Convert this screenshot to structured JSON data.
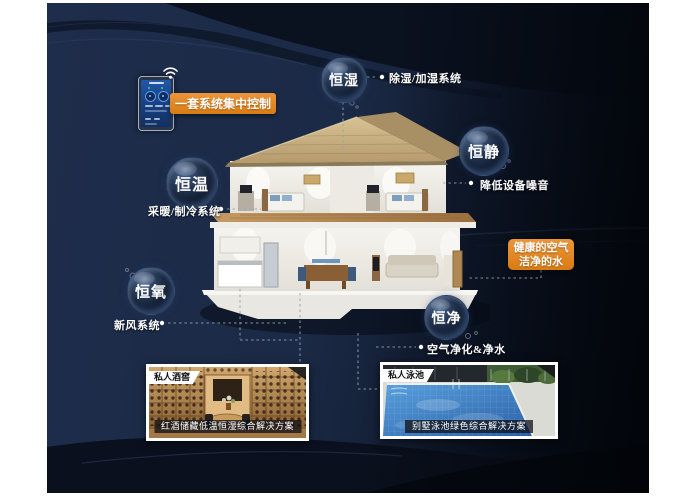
{
  "poster": {
    "control_callout": {
      "label": "一套系统集中控制"
    },
    "health_callout": {
      "line1": "健康的空气",
      "line2": "洁净的水"
    },
    "bubbles": [
      {
        "label": "恒湿",
        "note": "除湿/加湿系统"
      },
      {
        "label": "恒静",
        "note": "降低设备噪音"
      },
      {
        "label": "恒温",
        "note": "采暖/制冷系统"
      },
      {
        "label": "恒氧",
        "note": "新风系统"
      },
      {
        "label": "恒净",
        "note": "空气净化&净水"
      }
    ],
    "photos": [
      {
        "tag": "私人酒窖",
        "caption": "红酒储藏低温恒湿综合解决方案"
      },
      {
        "tag": "私人泳池",
        "caption": "别墅泳池绿色综合解决方案"
      }
    ],
    "icons": {
      "wifi": "wifi-icon",
      "control_panel": "smart-home-control-panel"
    },
    "colors": {
      "background_navy": "#1c2b47",
      "background_dark": "#0a1120",
      "accent_orange": "#e0861f",
      "connector_gray": "#9aa3b2"
    }
  }
}
